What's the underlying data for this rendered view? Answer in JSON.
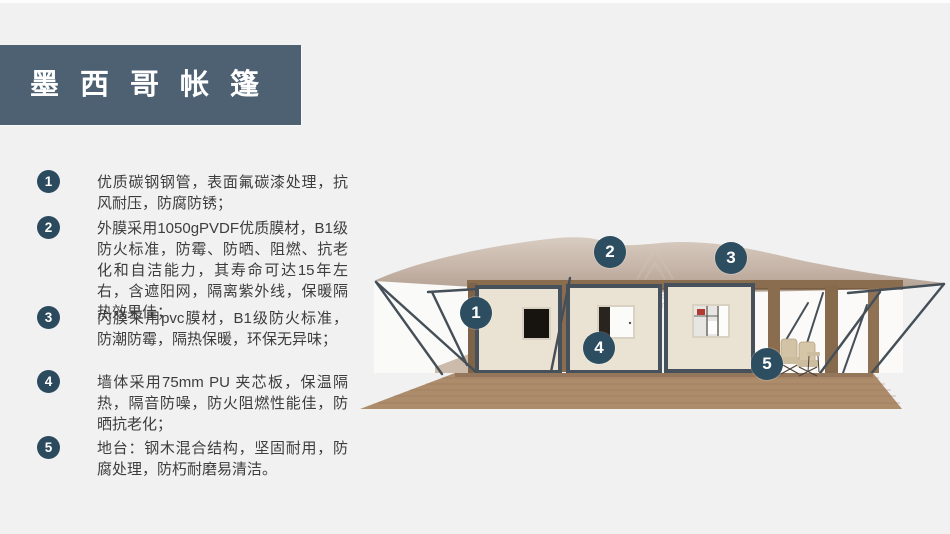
{
  "title": {
    "text": "墨西哥帐篷"
  },
  "features": [
    {
      "num": "1",
      "text": "优质碳钢钢管，表面氟碳漆处理，抗风耐压，防腐防锈；"
    },
    {
      "num": "2",
      "text": "外膜采用1050gPVDF优质膜材，B1级防火标准，防霉、防晒、阻燃、抗老化和自洁能力，其寿命可达15年左右，含遮阳网，隔离紫外线，保暖隔热效果佳；"
    },
    {
      "num": "3",
      "text": "内膜采用pvc膜材，B1级防火标准，防潮防霉，隔热保暖，环保无异味；"
    },
    {
      "num": "4",
      "text": "墙体采用75mm PU 夹芯板，保温隔热，隔音防噪，防火阻燃性能佳，防晒抗老化；"
    },
    {
      "num": "5",
      "text": "地台：钢木混合结构，坚固耐用，防腐处理，防朽耐磨易清洁。"
    }
  ],
  "image": {
    "callouts": [
      {
        "num": "1"
      },
      {
        "num": "2"
      },
      {
        "num": "3"
      },
      {
        "num": "4"
      },
      {
        "num": "5"
      }
    ],
    "watermark": {
      "cn": "雪利篷房",
      "en": "XUELI TENT"
    }
  },
  "colors": {
    "page_background": "#f1f1f2",
    "banner": "#4d6173",
    "badge": "#2c4a5e",
    "callout": "#2d4d61",
    "roof": "#c7b6a9",
    "wall_panel": "#eae3d3",
    "steel_frame": "#46515b",
    "wood_beam": "#8a6c4e",
    "deck": "#ad8c6c",
    "text": "#3d3d3d"
  }
}
